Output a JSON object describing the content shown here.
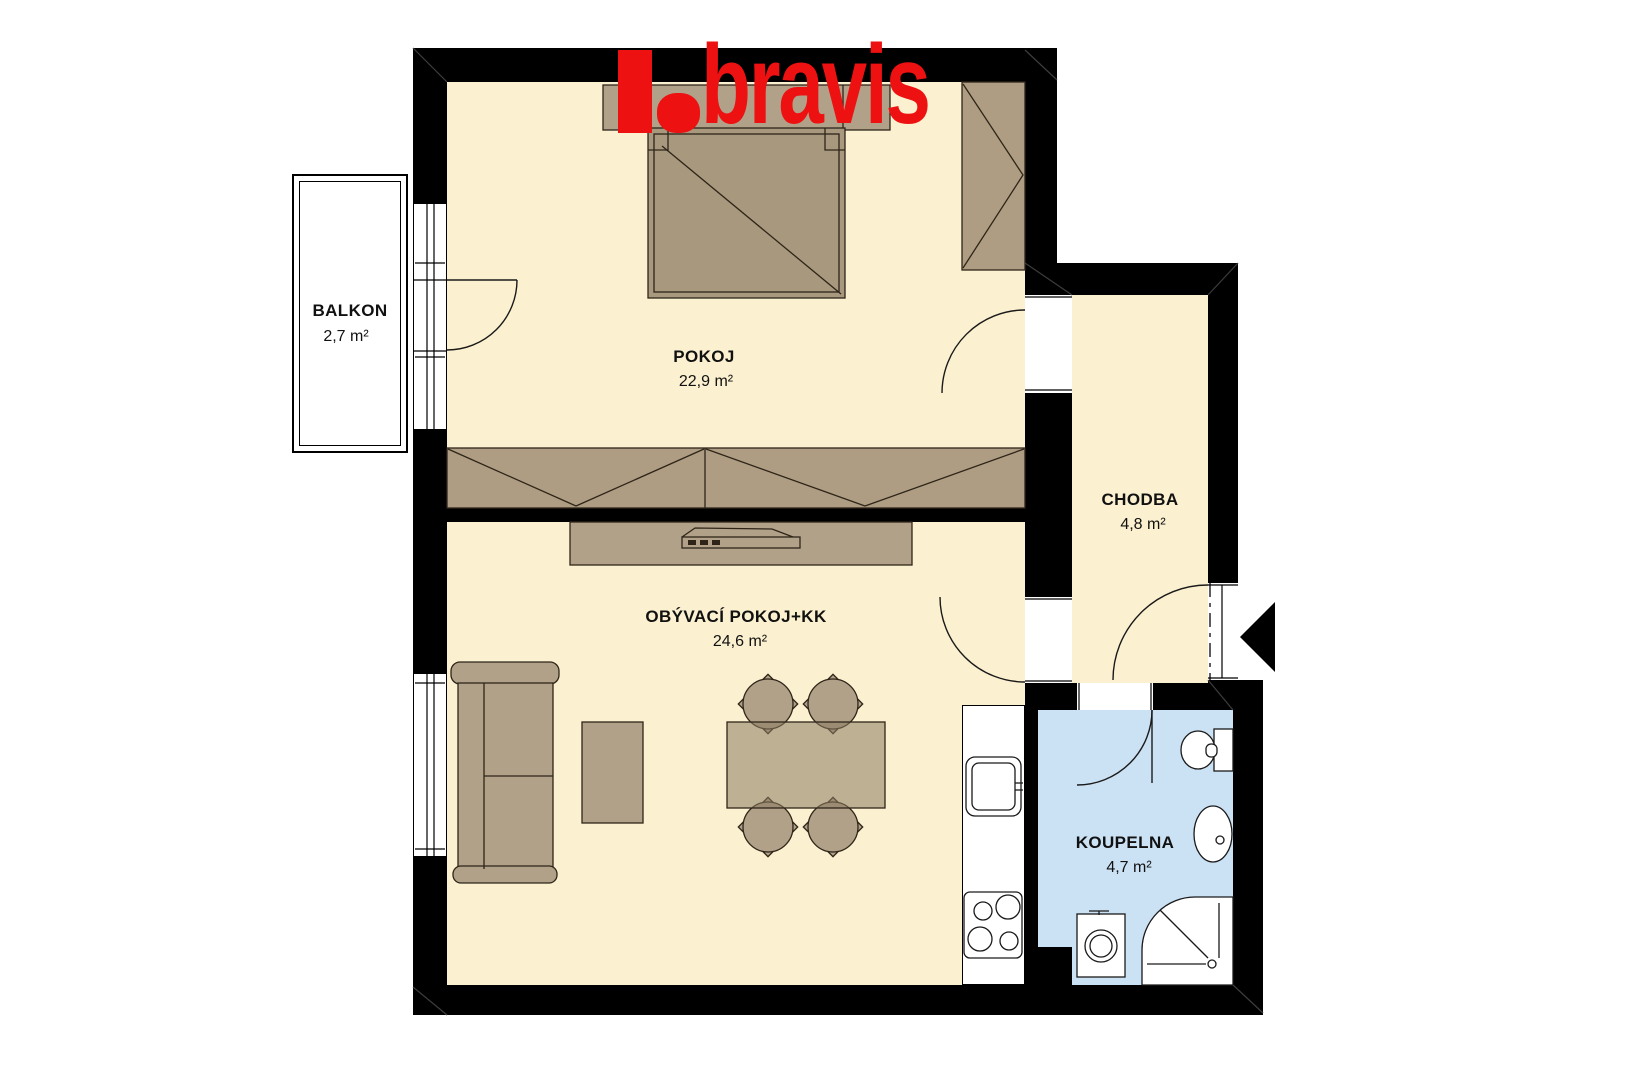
{
  "logo": {
    "text": "bravis",
    "color": "#EE1111"
  },
  "rooms": [
    {
      "name": "BALKON",
      "area": "2,7 m²"
    },
    {
      "name": "POKOJ",
      "area": "22,9 m²"
    },
    {
      "name": "CHODBA",
      "area": "4,8 m²"
    },
    {
      "name": "OBÝVACÍ POKOJ+KK",
      "area": "24,6 m²"
    },
    {
      "name": "KOUPELNA",
      "area": "4,7 m²"
    }
  ],
  "furniture": [
    "double-bed",
    "headboard-nightstands",
    "corner-wardrobe",
    "wardrobe-row",
    "tv-cabinet",
    "tv",
    "sofa",
    "coffee-table",
    "dining-table",
    "dining-chairs",
    "kitchen-counter",
    "kitchen-sink",
    "stove",
    "toilet",
    "bathroom-sink",
    "shower",
    "washing-machine"
  ],
  "symbols": [
    "door-arc",
    "entrance-arrow",
    "window",
    "dash-dot-entrance-door"
  ],
  "colors": {
    "wall": "#000000",
    "floor": "#FBF0CF",
    "bathroom_floor": "#CBE1F4",
    "furniture": "#B1A189",
    "bed": "#A8987E",
    "logo_red": "#EE1111"
  }
}
